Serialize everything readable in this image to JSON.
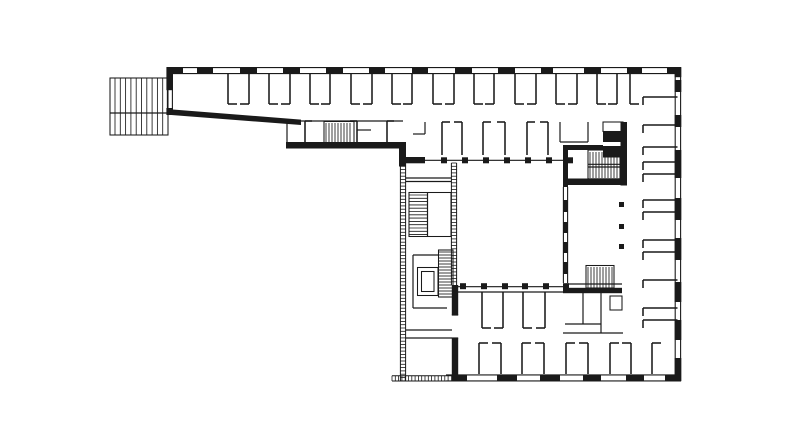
{
  "meta": {
    "description": "Black-and-white architectural floor plan line drawing: an L-shaped building with a north office wing, a hatched terrace at the west end, a main block with inner courtyard framed by colonnades, glazed west facade, four stair cores, an elevator, and perimeter walls drawn with window-dash pattern.",
    "background": "#ffffff",
    "ink": "#1a1a1a",
    "canvas_w": 792,
    "canvas_h": 442
  },
  "plan": {
    "poly": {
      "name": "south-wing-diagonal-wall",
      "points": [
        [
          166.5,
          109
        ],
        [
          301,
          119.6
        ],
        [
          301,
          125
        ],
        [
          166.5,
          114.6
        ]
      ]
    },
    "layers": [
      {
        "name": "facade-rails",
        "type": "lines",
        "w": 1.1,
        "items": [
          [
            166.5,
            67.6,
            681,
            67.6
          ],
          [
            166.5,
            73.6,
            675,
            73.6
          ],
          [
            675.2,
            67.6,
            675.2,
            381
          ],
          [
            680.6,
            67,
            680.6,
            381.4
          ],
          [
            446,
            374.9,
            681,
            374.9
          ],
          [
            446,
            380.9,
            681,
            380.9
          ],
          [
            167.4,
            90,
            167.4,
            108
          ],
          [
            172.4,
            90,
            172.4,
            108
          ],
          [
            563.4,
            187,
            563.4,
            283
          ],
          [
            567.6,
            187,
            567.6,
            283
          ]
        ]
      },
      {
        "name": "exterior-window-dashes",
        "type": "thick",
        "items": [
          [
            170,
            67.2,
            13,
            6.6
          ],
          [
            197,
            67.2,
            16,
            6.6
          ],
          [
            240,
            67.2,
            17,
            6.6
          ],
          [
            283,
            67.2,
            17,
            6.6
          ],
          [
            326,
            67.2,
            17,
            6.6
          ],
          [
            369,
            67.2,
            16,
            6.6
          ],
          [
            412,
            67.2,
            16,
            6.6
          ],
          [
            455,
            67.2,
            17,
            6.6
          ],
          [
            498,
            67.2,
            17,
            6.6
          ],
          [
            541,
            67.2,
            12,
            6.6
          ],
          [
            584,
            67.2,
            17,
            6.6
          ],
          [
            627,
            67.2,
            15,
            6.6
          ],
          [
            667,
            67.2,
            14,
            6.6
          ],
          [
            674.7,
            67.2,
            6.6,
            10
          ],
          [
            674.7,
            80,
            6.6,
            12
          ],
          [
            674.7,
            115,
            6.6,
            12
          ],
          [
            674.7,
            150,
            6.6,
            28
          ],
          [
            674.7,
            198,
            6.6,
            22
          ],
          [
            674.7,
            238,
            6.6,
            22
          ],
          [
            674.7,
            282,
            6.6,
            20
          ],
          [
            674.7,
            320,
            6.6,
            20
          ],
          [
            674.7,
            358,
            6.6,
            23
          ],
          [
            452,
            374.7,
            15,
            6.6
          ],
          [
            497,
            374.7,
            20,
            6.6
          ],
          [
            540,
            374.7,
            20,
            6.6
          ],
          [
            583,
            374.7,
            18,
            6.6
          ],
          [
            626,
            374.7,
            18,
            6.6
          ],
          [
            665,
            374.7,
            16,
            6.6
          ],
          [
            563,
            200,
            4.8,
            12
          ],
          [
            563,
            222,
            4.8,
            11
          ],
          [
            563,
            242,
            4.8,
            11
          ],
          [
            563,
            262,
            4.8,
            12
          ]
        ]
      },
      {
        "name": "bearing-walls",
        "type": "thick",
        "items": [
          [
            166.4,
            67.2,
            6.6,
            23
          ],
          [
            166.4,
            108,
            6.6,
            7
          ],
          [
            286,
            142,
            120,
            6.5
          ],
          [
            399,
            142,
            7,
            24.5
          ],
          [
            399,
            157,
            26,
            6.3
          ],
          [
            563,
            145,
            40,
            5
          ],
          [
            620.5,
            122,
            6.5,
            63.5
          ],
          [
            563,
            150,
            5,
            37
          ],
          [
            563,
            178.5,
            64,
            6.5
          ],
          [
            563,
            287.8,
            59,
            5.4
          ],
          [
            451.8,
            285,
            6.4,
            30
          ],
          [
            451.8,
            338,
            6.4,
            37
          ]
        ]
      },
      {
        "name": "shaft-blocks",
        "type": "thick",
        "items": [
          [
            603,
            132,
            20,
            10
          ],
          [
            603,
            146,
            20,
            11.5
          ]
        ]
      },
      {
        "name": "courtyard-columns",
        "type": "thick",
        "items": [
          [
            441,
            157.3,
            6,
            6
          ],
          [
            462,
            157.3,
            6,
            6
          ],
          [
            483,
            157.3,
            6,
            6
          ],
          [
            504,
            157.3,
            6,
            6
          ],
          [
            525,
            157.3,
            6,
            6
          ],
          [
            546,
            157.3,
            6,
            6
          ],
          [
            567,
            157.3,
            6,
            6
          ],
          [
            460,
            283.2,
            6,
            6
          ],
          [
            481,
            283.2,
            6,
            6
          ],
          [
            502,
            283.2,
            6,
            6
          ],
          [
            522,
            283.2,
            6,
            6
          ],
          [
            543,
            283.2,
            6,
            6
          ],
          [
            563,
            283.2,
            6,
            6
          ]
        ]
      },
      {
        "name": "gallery-column-dots",
        "type": "thick",
        "items": [
          [
            619,
            202,
            5,
            5
          ],
          [
            619,
            224,
            5,
            5
          ],
          [
            619,
            244,
            5,
            5
          ]
        ]
      },
      {
        "name": "interior-thin-walls",
        "type": "lines",
        "w": 1.2,
        "items": [
          [
            287,
            121,
            287,
            142
          ],
          [
            287,
            121,
            403,
            121
          ],
          [
            357,
            130,
            371,
            130
          ],
          [
            406,
            160.3,
            572,
            160.3
          ],
          [
            455,
            286.7,
            566,
            286.7
          ],
          [
            560,
            122,
            560,
            142
          ],
          [
            588,
            122,
            588,
            142
          ],
          [
            560,
            142,
            588,
            142
          ],
          [
            425,
            122,
            425,
            134
          ],
          [
            413,
            134,
            425,
            134
          ],
          [
            588,
            164.3,
            620,
            164.3
          ],
          [
            588,
            167,
            620,
            167
          ],
          [
            566,
            284,
            622,
            284
          ],
          [
            406,
            178,
            451,
            178
          ],
          [
            406,
            181.5,
            451,
            181.5
          ],
          [
            413,
            255,
            413,
            308
          ],
          [
            413,
            308,
            447,
            308
          ],
          [
            413,
            255,
            438,
            255
          ],
          [
            406,
            330,
            452,
            330
          ],
          [
            406,
            338,
            452,
            338
          ],
          [
            451.8,
            315,
            458.2,
            315
          ],
          [
            451.8,
            338,
            458.2,
            338
          ],
          [
            456,
            292,
            565,
            292
          ],
          [
            583,
            293,
            583,
            324
          ],
          [
            601,
            293,
            601,
            333
          ],
          [
            565,
            324,
            601,
            324
          ],
          [
            563,
            333,
            623,
            333
          ],
          [
            427.5,
            193,
            427.5,
            236.5
          ],
          [
            110,
            113,
            168,
            113
          ]
        ]
      },
      {
        "name": "stair-and-core-outlines",
        "type": "boxes",
        "items": [
          [
            110,
            78,
            58,
            57
          ],
          [
            324,
            121.5,
            30,
            24
          ],
          [
            603,
            122,
            20,
            9.5
          ],
          [
            588,
            150,
            32,
            28.8
          ],
          [
            586,
            265.5,
            28,
            22.5
          ],
          [
            409,
            192.5,
            42,
            44
          ],
          [
            438.5,
            250,
            14.5,
            47
          ],
          [
            417.5,
            267.5,
            20.5,
            28
          ],
          [
            421.5,
            271.5,
            12.5,
            20
          ],
          [
            610,
            296,
            12,
            14
          ]
        ]
      },
      {
        "name": "stair-treads-vertical",
        "type": "hatchv",
        "items": [
          [
            326,
            123,
            26,
            21.5,
            3
          ],
          [
            590,
            152,
            28,
            26,
            3
          ],
          [
            588,
            267,
            24,
            20.5,
            3
          ],
          [
            115,
            78,
            48,
            57,
            5.3
          ]
        ]
      },
      {
        "name": "stair-treads-horizontal",
        "type": "hatchh",
        "items": [
          [
            409.5,
            195,
            17.5,
            40,
            3.3
          ],
          [
            439,
            252,
            13,
            43,
            3
          ]
        ]
      },
      {
        "name": "glazed-curtain-walls",
        "type": "ladders",
        "items": [
          [
            403,
            163,
            218,
            "v"
          ],
          [
            454,
            163,
            122,
            "v"
          ],
          [
            392,
            378.4,
            60,
            "h"
          ]
        ]
      },
      {
        "name": "room-partitions-vertical",
        "type": "partv",
        "items": [
          {
            "xs": [
              228,
              249,
              269,
              290,
              310,
              330,
              351,
              372,
              392,
              412,
              433,
              454,
              474,
              494,
              515,
              536,
              556,
              577,
              597,
              617,
              630
            ],
            "y1": 74,
            "y2": 104,
            "stubAt": "y2",
            "stubLen": 9
          },
          {
            "xs": [
              442,
              462,
              483,
              505,
              527,
              548
            ],
            "y1": 122,
            "y2": 155,
            "stubAt": "y1",
            "stubLen": 8
          },
          {
            "xs": [
              305,
              357,
              387
            ],
            "y1": 121,
            "y2": 142,
            "stubAt": "y1",
            "stubLen": 7
          },
          {
            "xs": [
              482,
              503,
              523,
              545
            ],
            "y1": 292,
            "y2": 328,
            "stubAt": "y2",
            "stubLen": 9
          },
          {
            "xs": [
              479,
              501,
              522,
              544,
              566,
              588,
              610,
              631,
              652
            ],
            "y1": 343,
            "y2": 374,
            "stubAt": "y1",
            "stubLen": 9
          }
        ]
      },
      {
        "name": "room-partitions-horizontal",
        "type": "parth",
        "items": [
          {
            "ys": [
              97,
              125,
              147,
              162,
              174,
              200,
              212,
              240,
              252,
              280,
              308,
              320
            ],
            "x1": 643,
            "x2": 677.5,
            "stubLen": 8
          }
        ]
      }
    ]
  }
}
